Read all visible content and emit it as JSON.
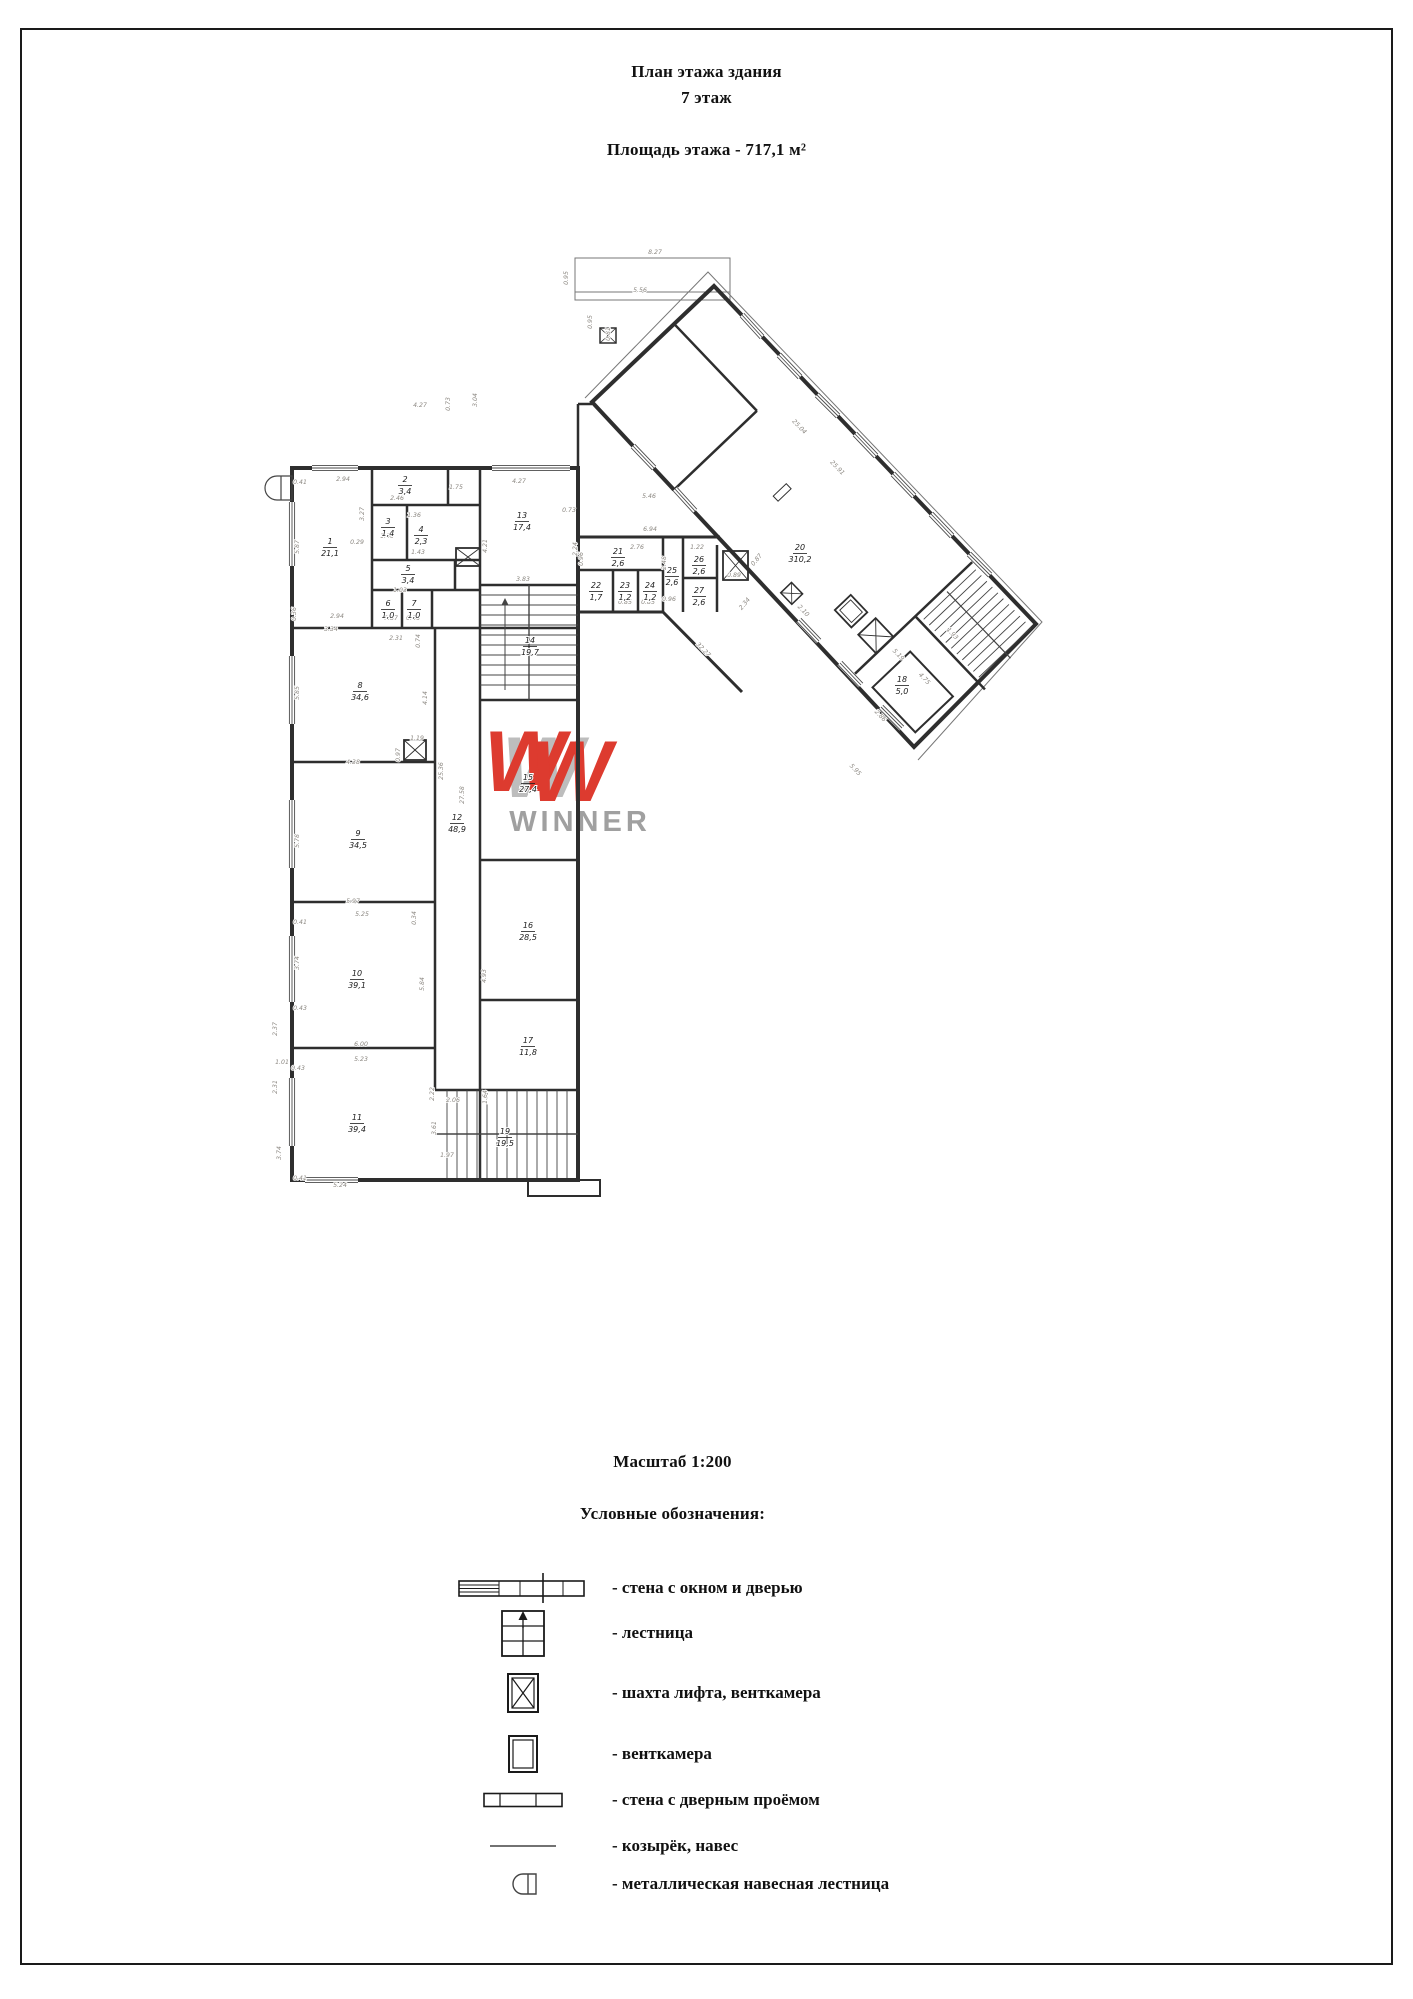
{
  "header": {
    "title_line1": "План этажа здания",
    "title_line2": "7 этаж",
    "area_line": "Площадь этажа - 717,1 м²"
  },
  "scale_label": "Масштаб 1:200",
  "legend": {
    "heading": "Условные обозначения:",
    "items": [
      {
        "icon": "wall-window-door-icon",
        "label": "- стена с окном и дверью"
      },
      {
        "icon": "stairs-icon",
        "label": "- лестница"
      },
      {
        "icon": "elevator-shaft-icon",
        "label": "- шахта лифта, венткамера"
      },
      {
        "icon": "vent-chamber-icon",
        "label": "- венткамера"
      },
      {
        "icon": "wall-doorway-icon",
        "label": "- стена с дверным проёмом"
      },
      {
        "icon": "canopy-icon",
        "label": "- козырёк, навес"
      },
      {
        "icon": "metal-ladder-icon",
        "label": "- металлическая навесная лестница"
      }
    ]
  },
  "watermark": {
    "logo_letter": "W",
    "text": "WINNER",
    "w_color": "#dd3b2f",
    "text_color": "#a0a0a0"
  },
  "colors": {
    "wall": "#2e2e2e",
    "thin_line": "#555555",
    "dimension_text": "#8b8781"
  },
  "plan": {
    "rooms": [
      [
        "1",
        "21,1",
        330,
        546
      ],
      [
        "2",
        "3,4",
        405,
        484
      ],
      [
        "3",
        "1,4",
        388,
        526
      ],
      [
        "4",
        "2,3",
        421,
        534
      ],
      [
        "5",
        "3,4",
        408,
        573
      ],
      [
        "6",
        "1,0",
        388,
        608
      ],
      [
        "7",
        "1,0",
        414,
        608
      ],
      [
        "8",
        "34,6",
        360,
        690
      ],
      [
        "9",
        "34,5",
        358,
        838
      ],
      [
        "10",
        "39,1",
        357,
        978
      ],
      [
        "11",
        "39,4",
        357,
        1122
      ],
      [
        "12",
        "48,9",
        457,
        822
      ],
      [
        "13",
        "17,4",
        522,
        520
      ],
      [
        "14",
        "19,7",
        530,
        645
      ],
      [
        "15",
        "27,4",
        528,
        782
      ],
      [
        "16",
        "28,5",
        528,
        930
      ],
      [
        "17",
        "11,8",
        528,
        1045
      ],
      [
        "18",
        "5,0",
        902,
        684
      ],
      [
        "19",
        "19,5",
        505,
        1136
      ],
      [
        "20",
        "310,2",
        800,
        552
      ],
      [
        "21",
        "2,6",
        618,
        556
      ],
      [
        "22",
        "1,7",
        596,
        590
      ],
      [
        "23",
        "1,2",
        625,
        590
      ],
      [
        "24",
        "1,2",
        650,
        590
      ],
      [
        "25",
        "2,6",
        672,
        575
      ],
      [
        "26",
        "2,6",
        699,
        564
      ],
      [
        "27",
        "2,6",
        699,
        595
      ]
    ],
    "dimensions": [
      [
        "8.27",
        655,
        254,
        0
      ],
      [
        "0.95",
        568,
        278,
        -90
      ],
      [
        "5.56",
        640,
        292,
        0
      ],
      [
        "0.95",
        592,
        322,
        -90
      ],
      [
        "0.81",
        610,
        334,
        -90
      ],
      [
        "4.27",
        420,
        407,
        0
      ],
      [
        "0.73",
        450,
        404,
        -90
      ],
      [
        "3.04",
        477,
        400,
        -90
      ],
      [
        "0.41",
        300,
        484,
        0
      ],
      [
        "2.94",
        343,
        481,
        0
      ],
      [
        "5.87",
        299,
        547,
        -90
      ],
      [
        "3.27",
        364,
        514,
        -90
      ],
      [
        "2.46",
        397,
        500,
        0
      ],
      [
        "1.36",
        414,
        517,
        0
      ],
      [
        "1.75",
        456,
        489,
        0
      ],
      [
        "1.00",
        387,
        538,
        0
      ],
      [
        "0.29",
        357,
        544,
        0
      ],
      [
        "1.43",
        418,
        554,
        0
      ],
      [
        "1.03",
        400,
        592,
        0
      ],
      [
        "0.87",
        391,
        620,
        0
      ],
      [
        "0.86",
        413,
        620,
        0
      ],
      [
        "2.31",
        396,
        640,
        0
      ],
      [
        "0.74",
        420,
        641,
        -90
      ],
      [
        "3.34",
        331,
        631,
        0
      ],
      [
        "2.94",
        337,
        618,
        0
      ],
      [
        "0.36",
        296,
        614,
        -90
      ],
      [
        "5.85",
        299,
        693,
        -90
      ],
      [
        "4.14",
        427,
        698,
        -90
      ],
      [
        "1.19",
        417,
        740,
        0
      ],
      [
        "0.97",
        400,
        755,
        -90
      ],
      [
        "4.38",
        353,
        764,
        0
      ],
      [
        "25.36",
        443,
        771,
        -90
      ],
      [
        "27.58",
        464,
        795,
        -90
      ],
      [
        "5.78",
        299,
        841,
        -90
      ],
      [
        "5.97",
        353,
        903,
        0
      ],
      [
        "5.25",
        362,
        916,
        0
      ],
      [
        "0.34",
        416,
        918,
        -90
      ],
      [
        "0.41",
        300,
        924,
        0
      ],
      [
        "3.74",
        299,
        963,
        -90
      ],
      [
        "5.84",
        424,
        984,
        -90
      ],
      [
        "4.93",
        486,
        976,
        -90
      ],
      [
        "0.43",
        300,
        1010,
        0
      ],
      [
        "2.37",
        277,
        1029,
        -90
      ],
      [
        "6.00",
        361,
        1046,
        0
      ],
      [
        "5.23",
        361,
        1061,
        0
      ],
      [
        "1.01",
        282,
        1064,
        0
      ],
      [
        "0.43",
        298,
        1070,
        0
      ],
      [
        "2.31",
        277,
        1087,
        -90
      ],
      [
        "2.22",
        434,
        1094,
        -90
      ],
      [
        "2.06",
        453,
        1102,
        0
      ],
      [
        "1.64",
        487,
        1097,
        -90
      ],
      [
        "3.61",
        436,
        1128,
        -90
      ],
      [
        "1.97",
        447,
        1157,
        0
      ],
      [
        "0.41",
        300,
        1180,
        0
      ],
      [
        "5.24",
        340,
        1187,
        0
      ],
      [
        "3.74",
        281,
        1153,
        -90
      ],
      [
        "4.27",
        519,
        483,
        0
      ],
      [
        "4.21",
        487,
        546,
        -90
      ],
      [
        "3.83",
        523,
        581,
        0
      ],
      [
        "2.24",
        577,
        549,
        -90
      ],
      [
        "0.73",
        569,
        512,
        0
      ],
      [
        "6.94",
        650,
        531,
        0
      ],
      [
        "2.76",
        637,
        549,
        0
      ],
      [
        "2.48",
        666,
        563,
        -90
      ],
      [
        "1.22",
        697,
        549,
        0
      ],
      [
        "0.96",
        583,
        559,
        -90
      ],
      [
        "0.85",
        625,
        604,
        0
      ],
      [
        "0.85",
        648,
        604,
        0
      ],
      [
        "0.96",
        669,
        601,
        0
      ],
      [
        "0.89",
        734,
        577,
        0
      ],
      [
        "2.34",
        746,
        605,
        -50
      ],
      [
        "0.87",
        758,
        561,
        -50
      ],
      [
        "5.46",
        649,
        498,
        0
      ],
      [
        "25.04",
        798,
        428,
        46
      ],
      [
        "25.91",
        836,
        469,
        46
      ],
      [
        "32.27",
        702,
        651,
        46
      ],
      [
        "2.10",
        802,
        612,
        46
      ],
      [
        "5.95",
        854,
        771,
        46
      ],
      [
        "5.19",
        897,
        656,
        46
      ],
      [
        "4.75",
        923,
        680,
        46
      ],
      [
        "2.86",
        879,
        717,
        46
      ],
      [
        "1.93",
        951,
        635,
        46
      ]
    ],
    "windows": [
      [
        292,
        502,
        292,
        566
      ],
      [
        292,
        656,
        292,
        724
      ],
      [
        292,
        800,
        292,
        868
      ],
      [
        292,
        936,
        292,
        1002
      ],
      [
        292,
        1078,
        292,
        1146
      ],
      [
        312,
        468,
        358,
        468
      ],
      [
        492,
        468,
        570,
        468
      ],
      [
        305,
        1180,
        358,
        1180
      ],
      [
        742,
        315,
        762,
        337
      ],
      [
        779,
        355,
        800,
        377
      ],
      [
        817,
        395,
        838,
        416
      ],
      [
        855,
        434,
        876,
        456
      ],
      [
        893,
        474,
        914,
        496
      ],
      [
        931,
        514,
        952,
        536
      ],
      [
        969,
        554,
        990,
        575
      ],
      [
        633,
        446,
        654,
        468
      ],
      [
        675,
        489,
        695,
        511
      ],
      [
        799,
        620,
        819,
        641
      ],
      [
        840,
        663,
        861,
        685
      ],
      [
        881,
        707,
        902,
        728
      ]
    ]
  }
}
